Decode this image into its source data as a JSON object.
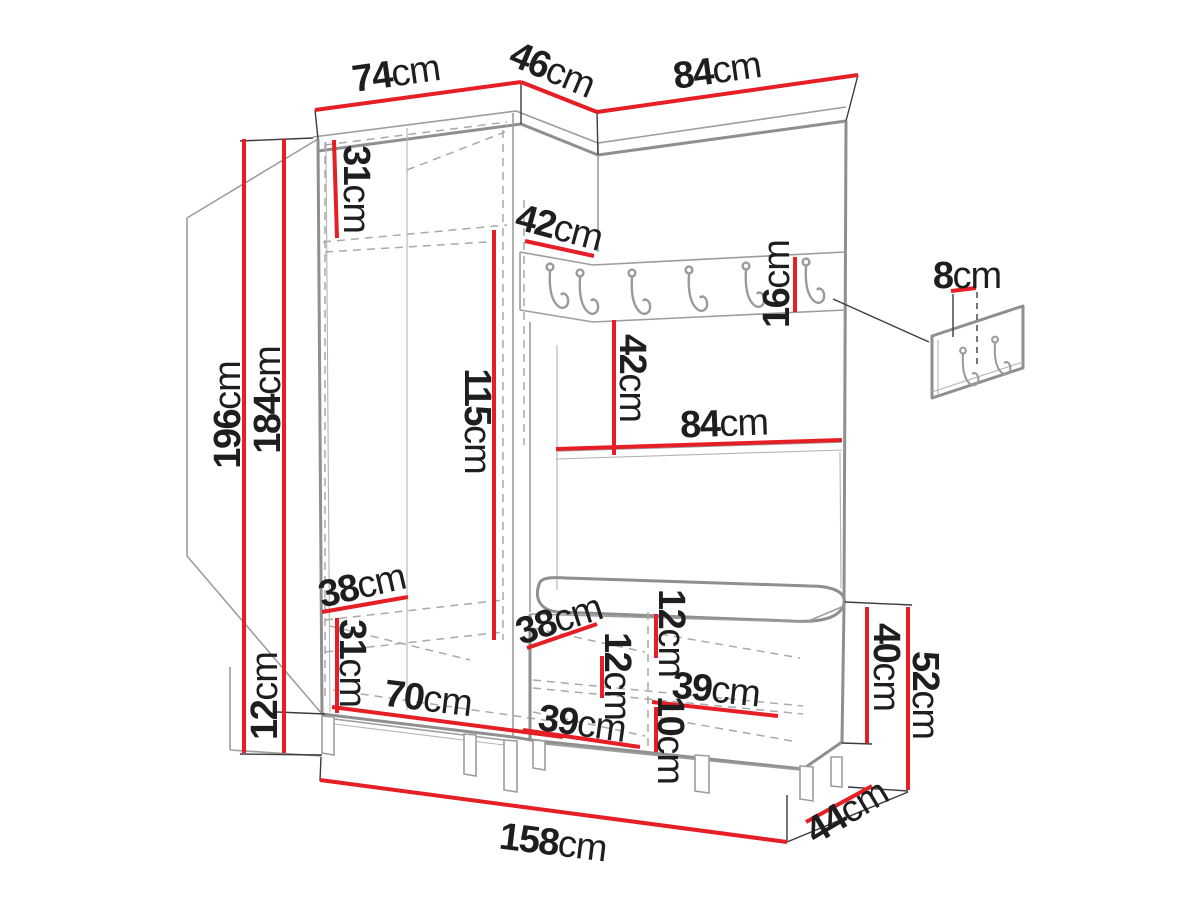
{
  "diagram": {
    "type": "furniture-dimension-diagram",
    "subject": "Hallway wardrobe set with corner coat-hook panel, shoe bench and separate wall hook panel",
    "unit": "cm"
  },
  "colors": {
    "dimension_line": "#e61e25",
    "structure_line": "#8f8f8f",
    "dashed_line": "#a9a9a9",
    "extension_line": "#3c3c3c",
    "label_text": "#1e1e1e",
    "background": "#ffffff"
  },
  "dimensions": [
    {
      "id": "wardrobe-width-top",
      "value": "74",
      "unit": "cm"
    },
    {
      "id": "corner-width-top",
      "value": "46",
      "unit": "cm"
    },
    {
      "id": "panel-width-top",
      "value": "84",
      "unit": "cm"
    },
    {
      "id": "total-height",
      "value": "196",
      "unit": "cm"
    },
    {
      "id": "body-height",
      "value": "184",
      "unit": "cm"
    },
    {
      "id": "leg-height",
      "value": "12",
      "unit": "cm"
    },
    {
      "id": "top-shelf-height",
      "value": "31",
      "unit": "cm"
    },
    {
      "id": "corner-shelf-depth",
      "value": "42",
      "unit": "cm"
    },
    {
      "id": "hook-rail-height",
      "value": "16",
      "unit": "cm"
    },
    {
      "id": "wall-panel-spacing",
      "value": "8",
      "unit": "cm"
    },
    {
      "id": "hanging-space-height",
      "value": "115",
      "unit": "cm"
    },
    {
      "id": "rail-to-shelf-height",
      "value": "42",
      "unit": "cm"
    },
    {
      "id": "shelf-width",
      "value": "84",
      "unit": "cm"
    },
    {
      "id": "wardrobe-depth",
      "value": "38",
      "unit": "cm"
    },
    {
      "id": "bottom-shelf-height",
      "value": "31",
      "unit": "cm"
    },
    {
      "id": "bench-depth",
      "value": "38",
      "unit": "cm"
    },
    {
      "id": "bench-top-section-height",
      "value": "12",
      "unit": "cm"
    },
    {
      "id": "bench-inner-height",
      "value": "12",
      "unit": "cm"
    },
    {
      "id": "bench-compartment-width-upper",
      "value": "39",
      "unit": "cm"
    },
    {
      "id": "bench-plinth-height",
      "value": "10",
      "unit": "cm"
    },
    {
      "id": "bench-compartment-width-lower",
      "value": "39",
      "unit": "cm"
    },
    {
      "id": "wardrobe-inner-width",
      "value": "70",
      "unit": "cm"
    },
    {
      "id": "bench-body-height",
      "value": "40",
      "unit": "cm"
    },
    {
      "id": "bench-total-height",
      "value": "52",
      "unit": "cm"
    },
    {
      "id": "total-width",
      "value": "158",
      "unit": "cm"
    },
    {
      "id": "total-depth",
      "value": "44",
      "unit": "cm"
    }
  ]
}
